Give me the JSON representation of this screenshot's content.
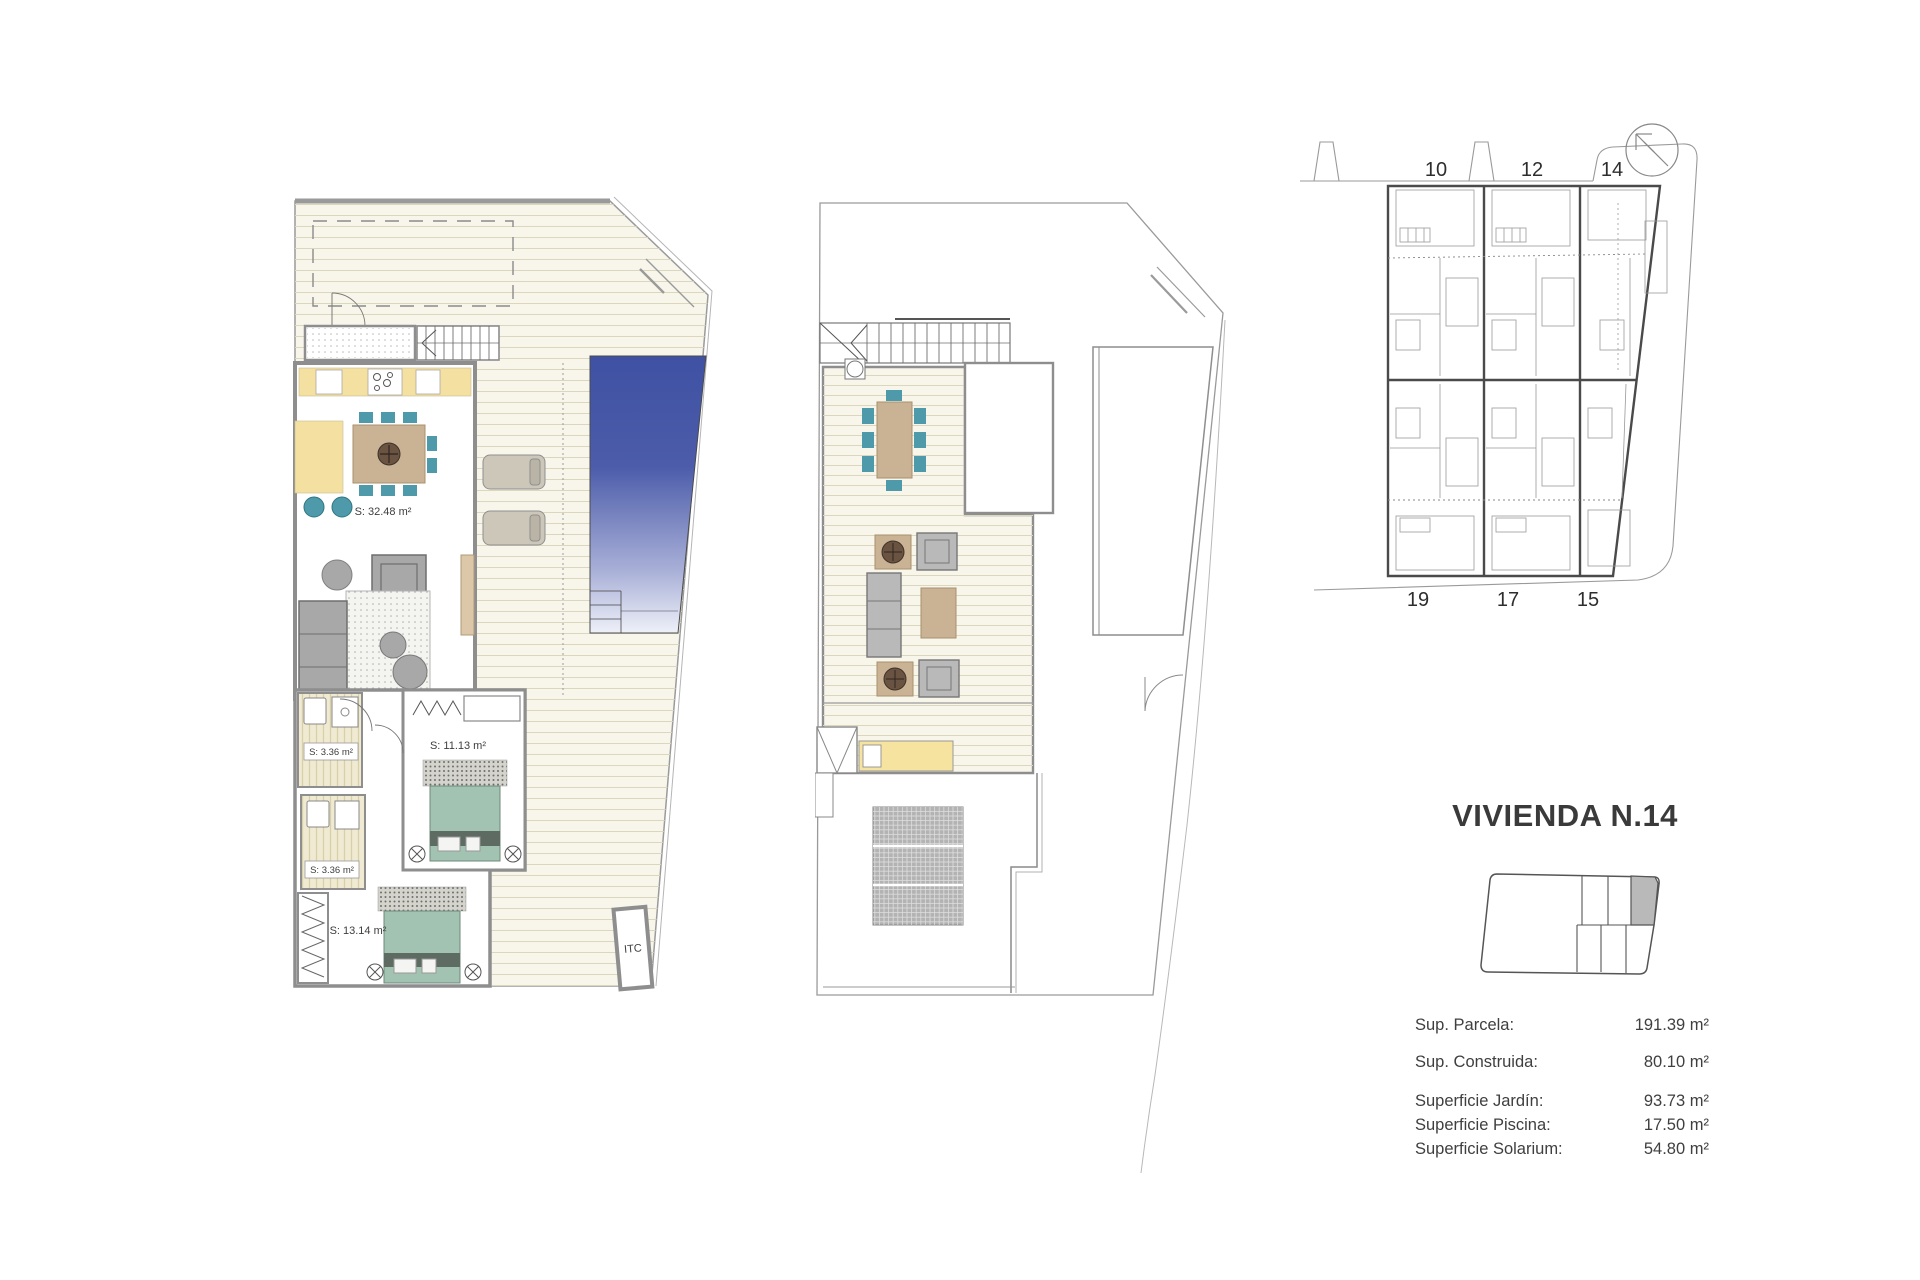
{
  "title": "VIVIENDA N.14",
  "site_plan": {
    "units_top": [
      "10",
      "12",
      "14"
    ],
    "units_bottom": [
      "19",
      "17",
      "15"
    ]
  },
  "ground_floor": {
    "labels": {
      "living": "S: 32.48 m²",
      "bath1": "S: 3.36 m²",
      "bath2": "S: 3.36 m²",
      "bedroom1": "S: 11.13 m²",
      "bedroom2": "S: 13.14 m²",
      "itc": "ITC"
    }
  },
  "specs": [
    {
      "label": "Sup. Parcela:",
      "value": "191.39 m²"
    },
    {
      "label": "Sup. Construida:",
      "value": "80.10 m²"
    },
    {
      "label": "Superficie Jardín:",
      "value": "93.73 m²"
    },
    {
      "label": "Superficie Piscina:",
      "value": "17.50 m²"
    },
    {
      "label": "Superficie Solarium:",
      "value": "54.80 m²"
    }
  ],
  "colors": {
    "pool_blue": "#3f51a3",
    "deck_cream": "#f8f6ea",
    "kitchen_yellow": "#f4e0a1",
    "wood_tan": "#cab295",
    "chair_teal": "#4e9aaa",
    "bed_green": "#a2c3b1",
    "wall_gray": "#8e8e8e",
    "text_dark": "#3a3a3a"
  }
}
